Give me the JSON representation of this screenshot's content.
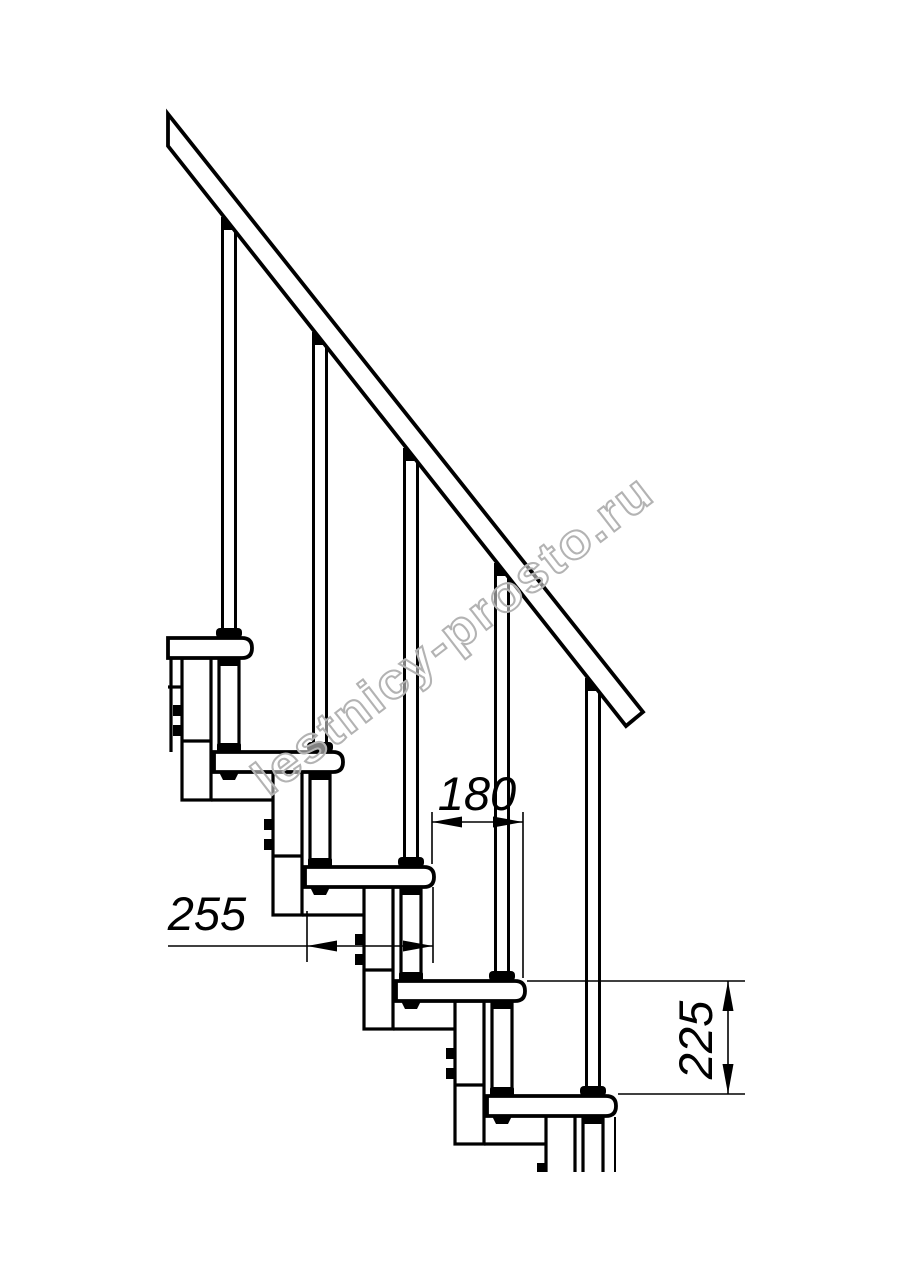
{
  "watermark": {
    "text": "lestnicy-prosto.ru",
    "color": "#b3b3b3"
  },
  "drawing": {
    "type": "modular-staircase-side-view",
    "visible_steps": 5,
    "visible_balusters": 5,
    "dimension_labels": {
      "going": "180",
      "tread_depth": "255",
      "rise": "225"
    },
    "colors": {
      "line": "#000000",
      "background": "#ffffff",
      "watermark": "#b3b3b3"
    }
  }
}
